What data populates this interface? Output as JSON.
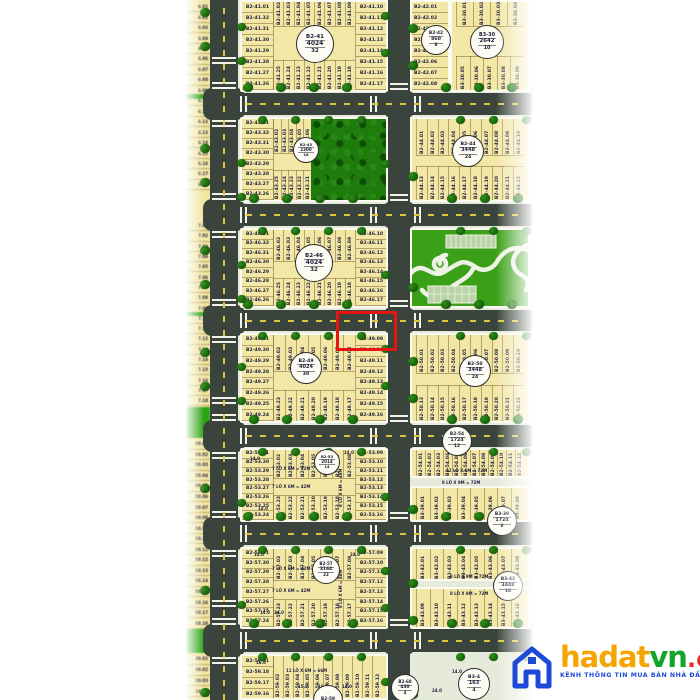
{
  "watermark": {
    "brand_ha": "hadat",
    "brand_vn": "vn",
    "brand_domain": ".com.vn",
    "tagline": "KÊNH THÔNG TIN MUA BÁN NHÀ ĐẤT UY TÍN"
  },
  "colors": {
    "plot_fill": "#f3e7a6",
    "road": "#3a443c",
    "tree_green": "#1c6b10",
    "park_green": "#3aa017",
    "forest_green": "#1e7c0c",
    "highlight_red": "#e51511",
    "badge_border": "#2e2e2e",
    "label_text": "#23233f",
    "brand_orange": "#f6a500",
    "brand_green": "#13a528",
    "brand_red": "#e53228",
    "brand_blue": "#1d49d8"
  },
  "highlight": {
    "plots": [
      "B2-49.09",
      "B2-49.10"
    ]
  },
  "blocks": [
    {
      "id": "b2_41",
      "badge": {
        "name": "B2-41",
        "area": "4024",
        "count": "32"
      },
      "left": [
        "B2-41.01",
        "B2-41.32",
        "B2-41.31",
        "B2-41.30",
        "B2-41.29",
        "B2-41.28",
        "B2-41.27",
        "B2-41.26"
      ],
      "right": [
        "B2-41.10",
        "B2-41.11",
        "B2-41.12",
        "B2-41.13",
        "B2-41.14",
        "B2-41.15",
        "B2-41.16",
        "B2-41.17"
      ],
      "top": [
        "B2-41.02",
        "B2-41.03",
        "B2-41.04",
        "B2-41.05",
        "B2-41.06",
        "B2-41.07",
        "B2-41.08",
        "B2-41.09"
      ],
      "bottom": [
        "B2-41.25",
        "B2-41.24",
        "B2-41.23",
        "B2-41.22",
        "B2-41.21",
        "B2-41.20",
        "B2-41.19",
        "B2-41.18"
      ]
    },
    {
      "id": "b2_42",
      "badge": {
        "name": "B2-42",
        "area": "860",
        "count": "8"
      },
      "rows": [
        "B2-42.01",
        "B2-42.02",
        "B2-42.03",
        "B2-42.04",
        "B2-42.05",
        "B2-42.06",
        "B2-42.07",
        "B2-42.08"
      ]
    },
    {
      "id": "b3_30",
      "badge": {
        "name": "B3-30",
        "area": "2642",
        "count": "10"
      },
      "top": [
        "B3-30.01",
        "B3-30.02",
        "B3-30.03",
        "B3-30.04"
      ],
      "bottom": [
        "B3-30.05",
        "B3-30.06",
        "B3-30.07",
        "B3-30.08",
        "B3-30.09"
      ]
    },
    {
      "id": "b2_43",
      "badge": {
        "name": "B2-43",
        "area": "2300",
        "count": "18"
      },
      "left": [
        "B2-43.01",
        "B2-43.32",
        "B2-43.31",
        "B2-43.30",
        "B2-43.29",
        "B2-43.28",
        "B2-43.27",
        "B2-43.26"
      ],
      "top": [
        "B2-43.02",
        "B2-43.03",
        "B2-43.04",
        "B2-43.05",
        "B2-43.06"
      ],
      "bottom": [
        "B2-43.25",
        "B2-43.24",
        "B2-43.23",
        "B2-43.22",
        "B2-43.21"
      ]
    },
    {
      "id": "b2_44",
      "badge": {
        "name": "B2-44",
        "area": "3448",
        "count": "24"
      },
      "top": [
        "B2-44.01",
        "B2-44.02",
        "B2-44.03",
        "B2-44.04",
        "B2-44.05",
        "B2-44.06",
        "B2-44.07",
        "B2-44.08",
        "B2-44.09",
        "B2-44.10"
      ],
      "bottom": [
        "B2-44.13",
        "B2-44.14",
        "B2-44.15",
        "B2-44.16",
        "B2-44.17",
        "B2-44.18",
        "B2-44.19",
        "B2-44.20",
        "B2-44.21",
        "B2-44.22"
      ]
    },
    {
      "id": "b2_46",
      "badge": {
        "name": "B2-46",
        "area": "4024",
        "count": "32"
      },
      "left": [
        "B2-46.01",
        "B2-46.32",
        "B2-46.31",
        "B2-46.30",
        "B2-46.29",
        "B2-46.28",
        "B2-46.27",
        "B2-46.26"
      ],
      "right": [
        "B2-46.10",
        "B2-46.11",
        "B2-46.12",
        "B2-46.13",
        "B2-46.14",
        "B2-46.15",
        "B2-46.16",
        "B2-46.17"
      ],
      "top": [
        "B2-46.02",
        "B2-46.03",
        "B2-46.04",
        "B2-46.05",
        "B2-46.06",
        "B2-46.07",
        "B2-46.08",
        "B2-46.09"
      ],
      "bottom": [
        "B2-46.25",
        "B2-46.24",
        "B2-46.23",
        "B2-46.22",
        "B2-46.21",
        "B2-46.20",
        "B2-46.19",
        "B2-46.18"
      ]
    },
    {
      "id": "b2_49",
      "badge": {
        "name": "B2-49",
        "area": "4024",
        "count": "30"
      },
      "left": [
        "B2-49.01",
        "B2-49.30",
        "B2-49.29",
        "B2-49.28",
        "B2-49.27",
        "B2-49.26",
        "B2-49.25",
        "B2-49.24"
      ],
      "right": [
        "B2-49.09",
        "B2-49.10",
        "B2-49.11",
        "B2-49.12",
        "B2-49.13",
        "B2-49.14",
        "B2-49.15",
        "B2-49.16"
      ],
      "top": [
        "B2-49.02",
        "B2-49.03",
        "B2-49.04",
        "B2-49.05",
        "B2-49.06",
        "B2-49.07",
        "B2-49.08"
      ],
      "bottom": [
        "B2-49.23",
        "B2-49.22",
        "B2-49.21",
        "B2-49.20",
        "B2-49.19",
        "B2-49.18",
        "B2-49.17"
      ]
    },
    {
      "id": "b2_50",
      "badge": {
        "name": "B2-50",
        "area": "3448",
        "count": "24"
      },
      "top": [
        "B2-50.01",
        "B2-50.02",
        "B2-50.03",
        "B2-50.04",
        "B2-50.05",
        "B2-50.06",
        "B2-50.07",
        "B2-50.08",
        "B2-50.09",
        "B2-50.10"
      ],
      "bottom": [
        "B2-50.13",
        "B2-50.14",
        "B2-50.15",
        "B2-50.16",
        "B2-50.17",
        "B2-50.18",
        "B2-50.19",
        "B2-50.20",
        "B2-50.21",
        "B2-50.22"
      ]
    },
    {
      "id": "b2_53",
      "badge": {
        "name": "B2-53",
        "area": "2014",
        "count": "14"
      },
      "left": [
        "B2-53.01",
        "B2-53.30",
        "B2-53.29",
        "B2-53.28",
        "B2-53.27",
        "B2-53.26",
        "B2-53.25",
        "B2-53.24"
      ],
      "right": [
        "B2-53.09",
        "B2-53.10",
        "B2-53.11",
        "B2-53.12",
        "B2-53.13",
        "B2-53.14",
        "B2-53.15",
        "B2-53.16"
      ],
      "top": [
        "B2-53.02",
        "B2-53.03",
        "B2-53.04",
        "B2-53.05",
        "B2-53.06",
        "B2-53.07",
        "B2-53.08"
      ],
      "bottom": [
        "B2-53.23",
        "B2-53.22",
        "B2-53.21",
        "B2-53.20",
        "B2-53.19",
        "B2-53.18",
        "B2-53.17"
      ],
      "annotations": [
        "24.0",
        "14.0",
        "7 LÔ X 6M = 42M",
        "7 LÔ X 6M = 42M",
        "8 LÔ X 6M = 48M",
        "14.0"
      ]
    },
    {
      "id": "b2_54",
      "badge": {
        "name": "B2-54",
        "area": "1724",
        "count": "12"
      },
      "top": [
        "B2-54.01",
        "B2-54.02",
        "B2-54.03",
        "B2-54.04",
        "B2-54.05",
        "B2-54.06",
        "B2-54.07",
        "B2-54.08",
        "B2-54.09",
        "B2-54.10",
        "B2-54.11",
        "B2-54.12"
      ],
      "annotations": [
        "12 LÔ X 6M = 72M"
      ]
    },
    {
      "id": "b3_39",
      "badge": {
        "name": "B3-39",
        "area": "1724",
        "count": "8"
      },
      "bottom": [
        "B3-39.01",
        "B3-39.02",
        "B3-39.03",
        "B3-39.04",
        "B3-39.05",
        "B3-39.06",
        "B3-39.07",
        "B3-39.08"
      ],
      "annotations": [
        "8 LÔ X 9M = 72M"
      ]
    },
    {
      "id": "b2_57",
      "badge": {
        "name": "B2-57",
        "area": "3164",
        "count": "22"
      },
      "left": [
        "B2-57.01",
        "B2-57.30",
        "B2-57.29",
        "B2-57.28",
        "B2-57.27",
        "B2-57.26",
        "B2-57.25",
        "B2-57.24"
      ],
      "right": [
        "B2-57.09",
        "B2-57.10",
        "B2-57.11",
        "B2-57.12",
        "B2-57.13",
        "B2-57.14",
        "B2-57.15",
        "B2-57.16"
      ],
      "top": [
        "B2-57.02",
        "B2-57.03",
        "B2-57.04",
        "B2-57.05",
        "B2-57.06",
        "B2-57.07",
        "B2-57.08"
      ],
      "bottom": [
        "B2-57.23",
        "B2-57.22",
        "B2-57.21",
        "B2-57.20",
        "B2-57.19",
        "B2-57.18",
        "B2-57.17"
      ],
      "annotations": [
        "14.0",
        "24.0",
        "7 LÔ X 6M = 42M",
        "7 LÔ X 6M = 42M",
        "8 LÔ X 6M = 48M",
        "14.0",
        "24.0"
      ]
    },
    {
      "id": "b3_43",
      "badge": {
        "name": "B3-43",
        "area": "3448",
        "count": "16"
      },
      "top": [
        "B3-43.01",
        "B3-43.02",
        "B3-43.03",
        "B3-43.04",
        "B3-43.05",
        "B3-43.06",
        "B3-43.07",
        "B3-43.08"
      ],
      "bottom": [
        "B3-43.09",
        "B3-43.10",
        "B3-43.11",
        "B3-43.12",
        "B3-43.13",
        "B3-43.14",
        "B3-43.15",
        "B3-43.16"
      ],
      "annotations": [
        "8 LÔ X 9M = 72M",
        "8 LÔ X 9M = 72M"
      ]
    },
    {
      "id": "b2_59",
      "badge": {
        "name": "B2-59"
      },
      "left": [
        "B2-59.01",
        "B2-59.18",
        "B2-59.17",
        "B2-59.16",
        "B2-59.15"
      ],
      "top": [
        "B2-59.02",
        "B2-59.03",
        "B2-59.04",
        "B2-59.05",
        "B2-59.06",
        "B2-59.07",
        "B2-59.08",
        "B2-59.09",
        "B2-59.10",
        "B2-59.11",
        "B2-59.12"
      ],
      "annotations": [
        "16.0",
        "11 LÔ X 6M = 66M",
        "15.0",
        "16.5",
        "14.0"
      ]
    },
    {
      "id": "b2_60",
      "badge": {
        "name": "B2-60",
        "area": "430",
        "count": "4"
      }
    },
    {
      "id": "b3_44",
      "badge": {
        "name": "B3-4",
        "area": "163",
        "count": "4"
      }
    }
  ],
  "left_strip": {
    "segments": [
      [
        "6.01",
        "6.02",
        "6.03",
        "6.04",
        "6.05",
        "6.06",
        "6.07",
        "6.08",
        "6.09",
        "6.10",
        "6.11",
        "6.12",
        "6.13",
        "6.14",
        "6.15",
        "6.16",
        "6.17",
        "6.18"
      ],
      [
        "7.01",
        "7.02",
        "7.03",
        "7.04",
        "7.05",
        "7.06",
        "7.07",
        "7.08",
        "7.09",
        "7.10",
        "7.11",
        "7.12",
        "7.13",
        "7.14",
        "7.15",
        "7.16",
        "7.17",
        "7.18"
      ],
      [
        "58.01",
        "58.02",
        "58.03",
        "58.04",
        "58.05",
        "58.06",
        "58.07",
        "58.08",
        "58.09",
        "58.10",
        "58.11",
        "58.12",
        "58.13",
        "58.14",
        "58.15",
        "58.16",
        "58.17",
        "58.18"
      ],
      [
        "39.01",
        "39.02",
        "39.03",
        "39.04",
        "39.05"
      ]
    ]
  },
  "misc_annotations": [
    "24.0",
    "14.0"
  ]
}
